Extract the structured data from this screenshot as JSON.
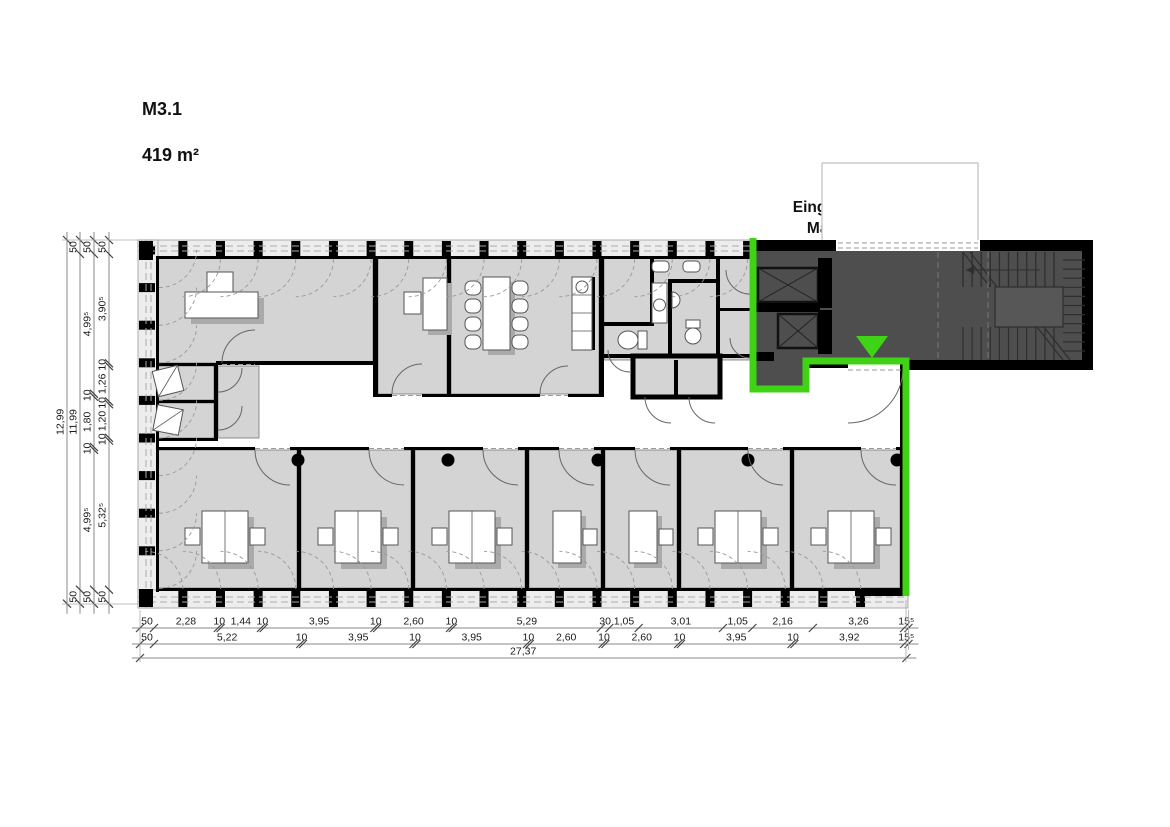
{
  "labels": {
    "unit_code": "M3.1",
    "unit_area": "419 m²",
    "entrance_line1": "Eingang / Treppenhaus",
    "entrance_line2": "Machtlfinger Str. 11"
  },
  "colors": {
    "room_fill": "#d4d4d4",
    "facade_fill": "#ededed",
    "stair_fill": "#4e4e4e",
    "landing_fill": "#575757",
    "highlight_green": "#3fd315",
    "wall": "#000000",
    "shadow": "#aaaaaa",
    "dim_line": "#888888"
  },
  "icons": {
    "entrance_marker": "green-triangle-down",
    "elevator": "rect-with-x-cross",
    "stairs": "treads-with-landing",
    "column": "black-dot",
    "toilet": "bowl-and-tank",
    "sink": "circle-basin"
  },
  "dimensions": {
    "scale_px_per_m": 28.0,
    "total_bottom_label": "27,37",
    "bottom_rows": [
      {
        "id": "row1",
        "segments": [
          {
            "label": "50",
            "m": 0.5
          },
          {
            "label": "2,28",
            "m": 2.28
          },
          {
            "label": "10",
            "m": 0.1
          },
          {
            "label": "1,44",
            "m": 1.44
          },
          {
            "label": "10",
            "m": 0.1
          },
          {
            "label": "3,95",
            "m": 3.95
          },
          {
            "label": "10",
            "m": 0.1
          },
          {
            "label": "2,60",
            "m": 2.6
          },
          {
            "label": "10",
            "m": 0.1
          },
          {
            "label": "5,29",
            "m": 5.29
          },
          {
            "label": "30",
            "m": 0.3
          },
          {
            "label": "1,05",
            "m": 1.05
          },
          {
            "label": "3,01",
            "m": 3.01
          },
          {
            "label": "1,05",
            "m": 1.05
          },
          {
            "label": "2,16",
            "m": 2.16
          },
          {
            "label": "3,26",
            "m": 3.26
          },
          {
            "label": "15⁵",
            "m": 0.155
          }
        ]
      },
      {
        "id": "row2",
        "segments": [
          {
            "label": "50",
            "m": 0.5
          },
          {
            "label": "5,22",
            "m": 5.22
          },
          {
            "label": "10",
            "m": 0.1
          },
          {
            "label": "3,95",
            "m": 3.95
          },
          {
            "label": "10",
            "m": 0.1
          },
          {
            "label": "3,95",
            "m": 3.95
          },
          {
            "label": "10",
            "m": 0.1
          },
          {
            "label": "2,60",
            "m": 2.6
          },
          {
            "label": "10",
            "m": 0.1
          },
          {
            "label": "2,60",
            "m": 2.6
          },
          {
            "label": "10",
            "m": 0.1
          },
          {
            "label": "3,95",
            "m": 3.95
          },
          {
            "label": "10",
            "m": 0.1
          },
          {
            "label": "3,92",
            "m": 3.92
          },
          {
            "label": "15⁵",
            "m": 0.155
          }
        ]
      },
      {
        "id": "row3",
        "segments": [
          {
            "label": "27,37",
            "m": 27.37
          }
        ]
      }
    ],
    "left_cols": [
      {
        "id": "col1",
        "segments": [
          {
            "label": "12,99",
            "m": 12.99
          }
        ]
      },
      {
        "id": "col2",
        "segments": [
          {
            "label": "50",
            "m": 0.5
          },
          {
            "label": "11,99",
            "m": 11.99
          },
          {
            "label": "50",
            "m": 0.5
          }
        ]
      },
      {
        "id": "col3",
        "segments": [
          {
            "label": "50",
            "m": 0.5
          },
          {
            "label": "4,99⁵",
            "m": 4.995
          },
          {
            "label": "10",
            "m": 0.1
          },
          {
            "label": "1,80",
            "m": 1.8
          },
          {
            "label": "10",
            "m": 0.1
          },
          {
            "label": "4,99⁵",
            "m": 4.995
          },
          {
            "label": "50",
            "m": 0.5
          }
        ]
      },
      {
        "id": "col4",
        "segments": [
          {
            "label": "50",
            "m": 0.5
          },
          {
            "label": "3,90⁵",
            "m": 3.905
          },
          {
            "label": "10",
            "m": 0.1
          },
          {
            "label": "1,26",
            "m": 1.26
          },
          {
            "label": "10",
            "m": 0.1
          },
          {
            "label": "1,20",
            "m": 1.2
          },
          {
            "label": "10",
            "m": 0.1
          },
          {
            "label": "5,32⁵",
            "m": 5.325
          },
          {
            "label": "50",
            "m": 0.5
          }
        ]
      }
    ]
  }
}
